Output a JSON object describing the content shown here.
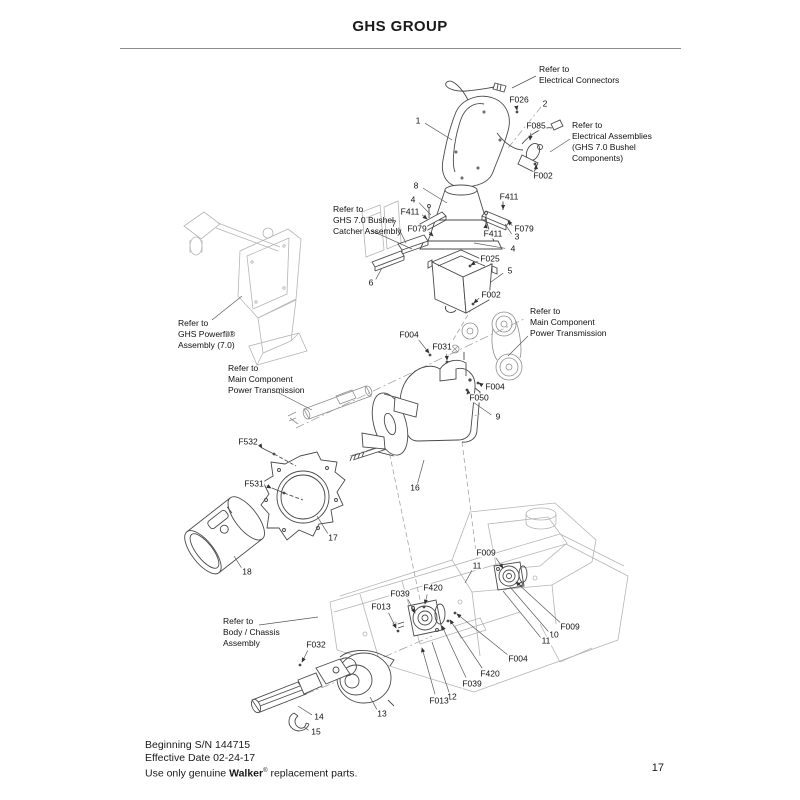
{
  "title": "GHS GROUP",
  "page": {
    "number": "17"
  },
  "footer": {
    "serial_line": "Beginning S/N 144715",
    "date_line": "Effective Date 02-24-17",
    "notice_prefix": "Use only genuine ",
    "notice_brand": "Walker",
    "notice_reg": "®",
    "notice_suffix": " replacement parts."
  },
  "colors": {
    "ink": "#1a1a1a",
    "part_line": "#4a4a4a",
    "reference_line": "#b5b5b5",
    "rule": "#8c8c8c"
  },
  "notes": [
    {
      "id": "electrical-connectors",
      "x": 539,
      "y": 64,
      "lines": [
        "Refer to",
        "Electrical Connectors"
      ],
      "leader": [
        536,
        76,
        512,
        88
      ]
    },
    {
      "id": "electrical-assemblies",
      "x": 572,
      "y": 120,
      "lines": [
        "Refer to",
        "Electrical Assemblies",
        "(GHS 7.0 Bushel",
        "Components)"
      ],
      "leader": [
        570,
        139,
        550,
        152
      ]
    },
    {
      "id": "catcher-assembly",
      "x": 333,
      "y": 204,
      "lines": [
        "Refer to",
        "GHS 7.0 Bushel",
        "Catcher Assembly"
      ],
      "leader": [
        372,
        231,
        412,
        249
      ]
    },
    {
      "id": "powerfil-assembly",
      "x": 178,
      "y": 318,
      "lines": [
        "Refer to",
        "GHS Powerfil®",
        "Assembly (7.0)"
      ],
      "leader": [
        212,
        320,
        242,
        296
      ]
    },
    {
      "id": "power-transmission-right",
      "x": 530,
      "y": 306,
      "lines": [
        "Refer to",
        "Main Component",
        "Power Transmission"
      ],
      "leader": [
        528,
        336,
        508,
        356
      ]
    },
    {
      "id": "power-transmission-left",
      "x": 228,
      "y": 363,
      "lines": [
        "Refer to",
        "Main Component",
        "Power Transmission"
      ],
      "leader": [
        277,
        392,
        312,
        410
      ]
    },
    {
      "id": "body-chassis-assembly",
      "x": 223,
      "y": 616,
      "lines": [
        "Refer to",
        "Body / Chassis",
        "Assembly"
      ],
      "leader": [
        259,
        625,
        318,
        617
      ]
    }
  ],
  "callouts": [
    {
      "t": "1",
      "x": 418,
      "y": 121,
      "lx": 452,
      "ly": 140
    },
    {
      "t": "F026",
      "x": 519,
      "y": 100,
      "lx": 517,
      "ly": 110,
      "arrow": true
    },
    {
      "t": "2",
      "x": 545,
      "y": 104
    },
    {
      "t": "F085",
      "x": 536,
      "y": 126,
      "lx": 530,
      "ly": 140,
      "arrow": true
    },
    {
      "t": "F002",
      "x": 543,
      "y": 176,
      "lx": 536,
      "ly": 165,
      "arrow": true
    },
    {
      "t": "8",
      "x": 416,
      "y": 186,
      "lx": 447,
      "ly": 203
    },
    {
      "t": "4",
      "x": 413,
      "y": 200,
      "lx": 431,
      "ly": 215
    },
    {
      "t": "F411",
      "x": 410,
      "y": 212,
      "lx": 427,
      "ly": 219,
      "arrow": true
    },
    {
      "t": "F411",
      "x": 509,
      "y": 197,
      "lx": 503,
      "ly": 209,
      "arrow": true
    },
    {
      "t": "7",
      "x": 394,
      "y": 224,
      "lx": 406,
      "ly": 243
    },
    {
      "t": "F079",
      "x": 417,
      "y": 229,
      "lx": 433,
      "ly": 236,
      "arrow": true
    },
    {
      "t": "F079",
      "x": 524,
      "y": 229,
      "lx": 508,
      "ly": 221,
      "arrow": true
    },
    {
      "t": "3",
      "x": 517,
      "y": 237,
      "lx": 505,
      "ly": 224
    },
    {
      "t": "F411",
      "x": 493,
      "y": 234,
      "lx": 486,
      "ly": 224,
      "arrow": true
    },
    {
      "t": "4",
      "x": 513,
      "y": 249,
      "lx": 474,
      "ly": 243
    },
    {
      "t": "F025",
      "x": 490,
      "y": 259,
      "lx": 471,
      "ly": 265,
      "arrow": true
    },
    {
      "t": "6",
      "x": 371,
      "y": 283,
      "lx": 382,
      "ly": 268
    },
    {
      "t": "5",
      "x": 510,
      "y": 271,
      "lx": 491,
      "ly": 282
    },
    {
      "t": "F002",
      "x": 491,
      "y": 295,
      "lx": 474,
      "ly": 303,
      "arrow": true
    },
    {
      "t": "F004",
      "x": 409,
      "y": 335,
      "lx": 429,
      "ly": 353,
      "arrow": true
    },
    {
      "t": "F031",
      "x": 442,
      "y": 347,
      "lx": 447,
      "ly": 360,
      "arrow": true
    },
    {
      "t": "F004",
      "x": 495,
      "y": 387,
      "lx": 479,
      "ly": 383,
      "arrow": true
    },
    {
      "t": "F050",
      "x": 479,
      "y": 398,
      "lx": 468,
      "ly": 390,
      "arrow": true
    },
    {
      "t": "9",
      "x": 498,
      "y": 417,
      "lx": 473,
      "ly": 402
    },
    {
      "t": "F532",
      "x": 248,
      "y": 442,
      "lx": 262,
      "ly": 448,
      "arrow": true
    },
    {
      "t": "F531",
      "x": 254,
      "y": 484,
      "lx": 271,
      "ly": 488,
      "arrow": true
    },
    {
      "t": "16",
      "x": 415,
      "y": 488,
      "lx": 424,
      "ly": 460
    },
    {
      "t": "17",
      "x": 333,
      "y": 538,
      "lx": 317,
      "ly": 516
    },
    {
      "t": "18",
      "x": 247,
      "y": 572,
      "lx": 234,
      "ly": 556
    },
    {
      "t": "F009",
      "x": 486,
      "y": 553,
      "lx": 503,
      "ly": 568,
      "arrow": true
    },
    {
      "t": "11",
      "x": 477,
      "y": 566,
      "lx": 465,
      "ly": 583
    },
    {
      "t": "F420",
      "x": 433,
      "y": 588,
      "lx": 425,
      "ly": 604,
      "arrow": true
    },
    {
      "t": "F039",
      "x": 400,
      "y": 594,
      "lx": 415,
      "ly": 613,
      "arrow": true
    },
    {
      "t": "F013",
      "x": 381,
      "y": 607,
      "lx": 396,
      "ly": 628,
      "arrow": true
    },
    {
      "t": "F009",
      "x": 570,
      "y": 627,
      "lx": 516,
      "ly": 582,
      "arrow": true
    },
    {
      "t": "10",
      "x": 554,
      "y": 635,
      "lx": 510,
      "ly": 587
    },
    {
      "t": "11",
      "x": 546,
      "y": 641,
      "lx": 503,
      "ly": 591
    },
    {
      "t": "F004",
      "x": 518,
      "y": 659,
      "lx": 457,
      "ly": 614,
      "arrow": true
    },
    {
      "t": "F420",
      "x": 490,
      "y": 674,
      "lx": 450,
      "ly": 620,
      "arrow": true
    },
    {
      "t": "F039",
      "x": 472,
      "y": 684,
      "lx": 442,
      "ly": 626,
      "arrow": true
    },
    {
      "t": "12",
      "x": 452,
      "y": 697,
      "lx": 432,
      "ly": 642
    },
    {
      "t": "F013",
      "x": 439,
      "y": 701,
      "lx": 422,
      "ly": 648,
      "arrow": true
    },
    {
      "t": "13",
      "x": 382,
      "y": 714,
      "lx": 370,
      "ly": 697
    },
    {
      "t": "F032",
      "x": 316,
      "y": 645,
      "lx": 302,
      "ly": 662,
      "arrow": true
    },
    {
      "t": "14",
      "x": 319,
      "y": 717,
      "lx": 298,
      "ly": 706
    },
    {
      "t": "15",
      "x": 316,
      "y": 732,
      "lx": 304,
      "ly": 727
    }
  ]
}
